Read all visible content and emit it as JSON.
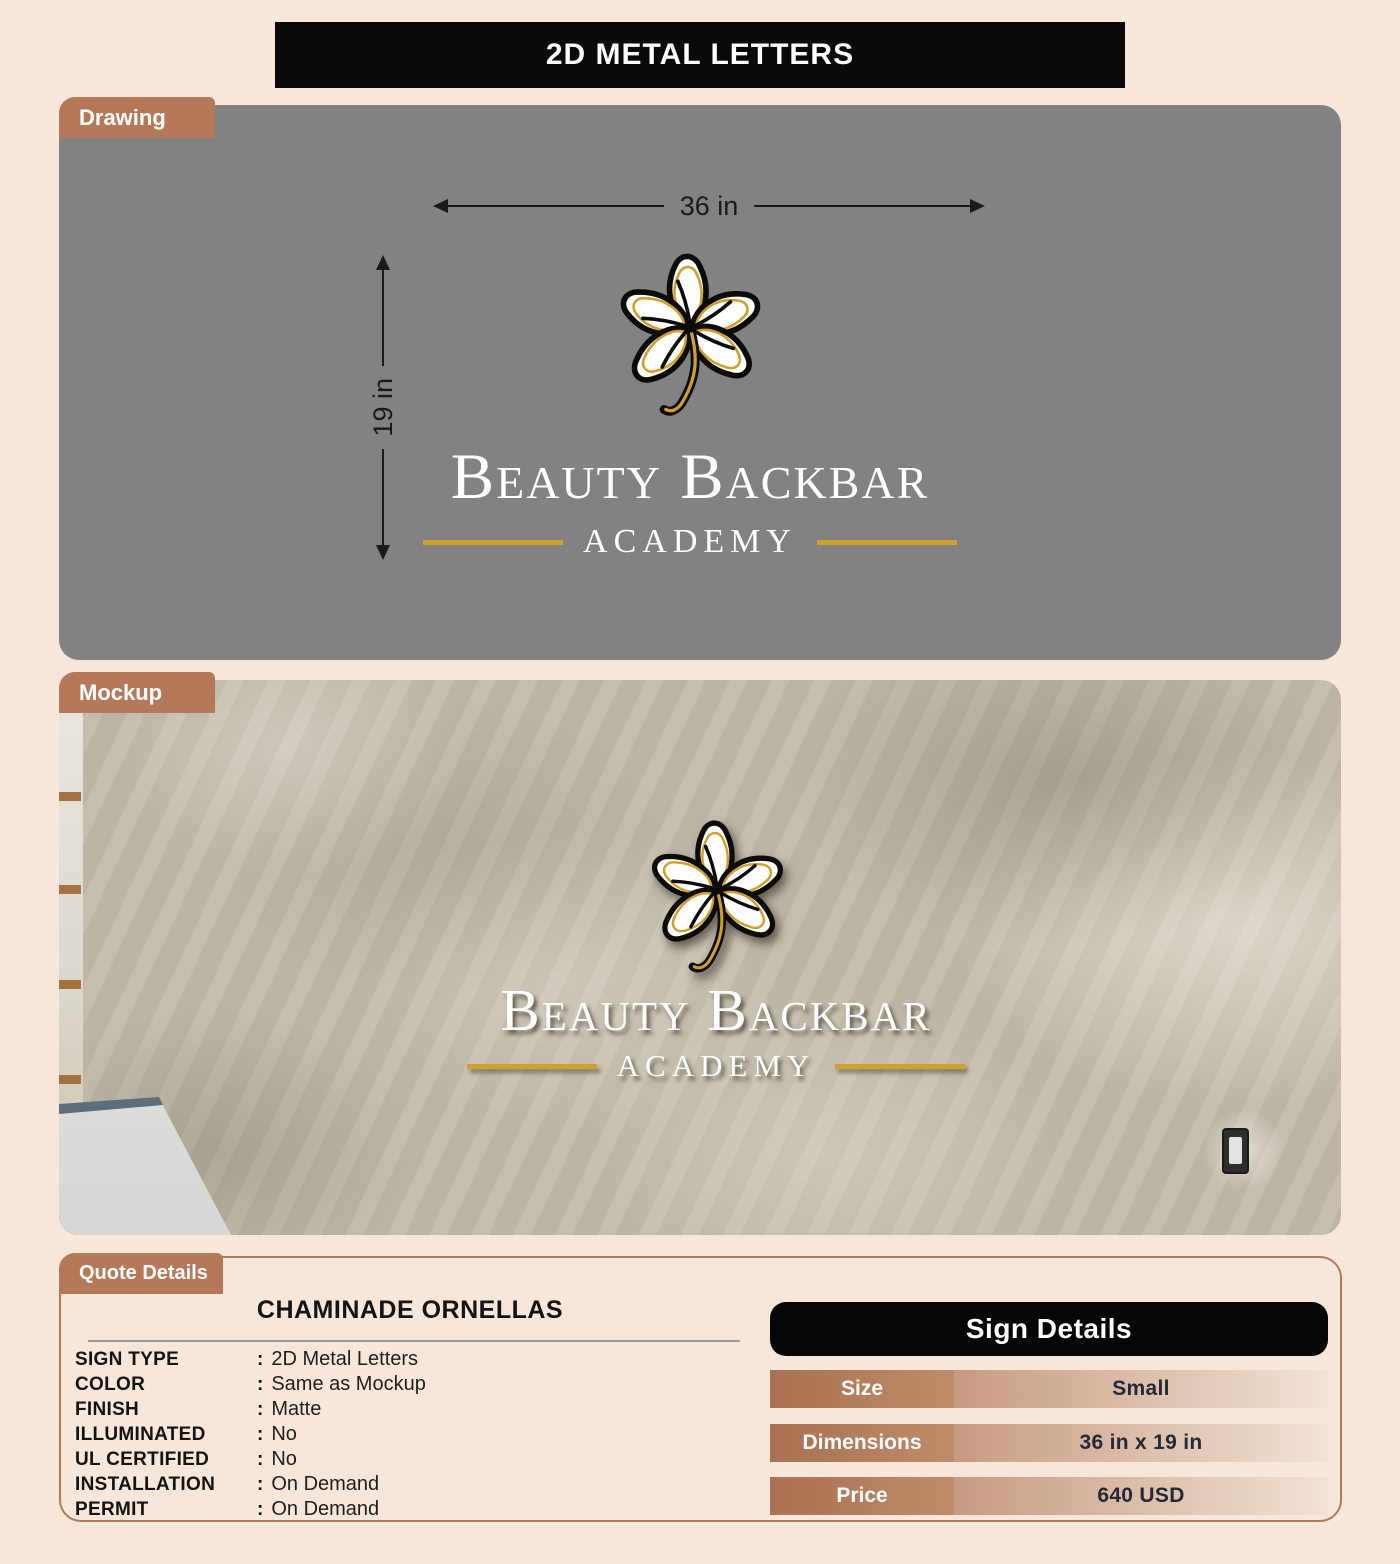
{
  "page": {
    "title": "2D METAL LETTERS"
  },
  "colors": {
    "accent": "#b5795a",
    "gold": "#cfa02c",
    "panel_gray": "#828282",
    "page_bg": "#f7e6da",
    "header_black": "#0b0909"
  },
  "drawing": {
    "tab": "Drawing",
    "width_label": "36 in",
    "height_label": "19 in"
  },
  "mockup": {
    "tab": "Mockup"
  },
  "logo": {
    "name_line": "Beauty Backbar",
    "sub_line": "ACADEMY"
  },
  "quote": {
    "tab": "Quote Details",
    "customer": "CHAMINADE ORNELLAS",
    "colon": ":",
    "fields": [
      {
        "label": "SIGN TYPE",
        "value": "2D Metal Letters"
      },
      {
        "label": "COLOR",
        "value": "Same as Mockup"
      },
      {
        "label": "FINISH",
        "value": "Matte"
      },
      {
        "label": "ILLUMINATED",
        "value": "No"
      },
      {
        "label": "UL CERTIFIED",
        "value": "No"
      },
      {
        "label": "INSTALLATION",
        "value": "On Demand"
      },
      {
        "label": "PERMIT",
        "value": "On Demand"
      }
    ],
    "table": {
      "title": "Sign Details",
      "rows": [
        {
          "label": "Size",
          "value": "Small"
        },
        {
          "label": "Dimensions",
          "value": "36 in x 19 in"
        },
        {
          "label": "Price",
          "value": "640 USD"
        }
      ]
    }
  }
}
